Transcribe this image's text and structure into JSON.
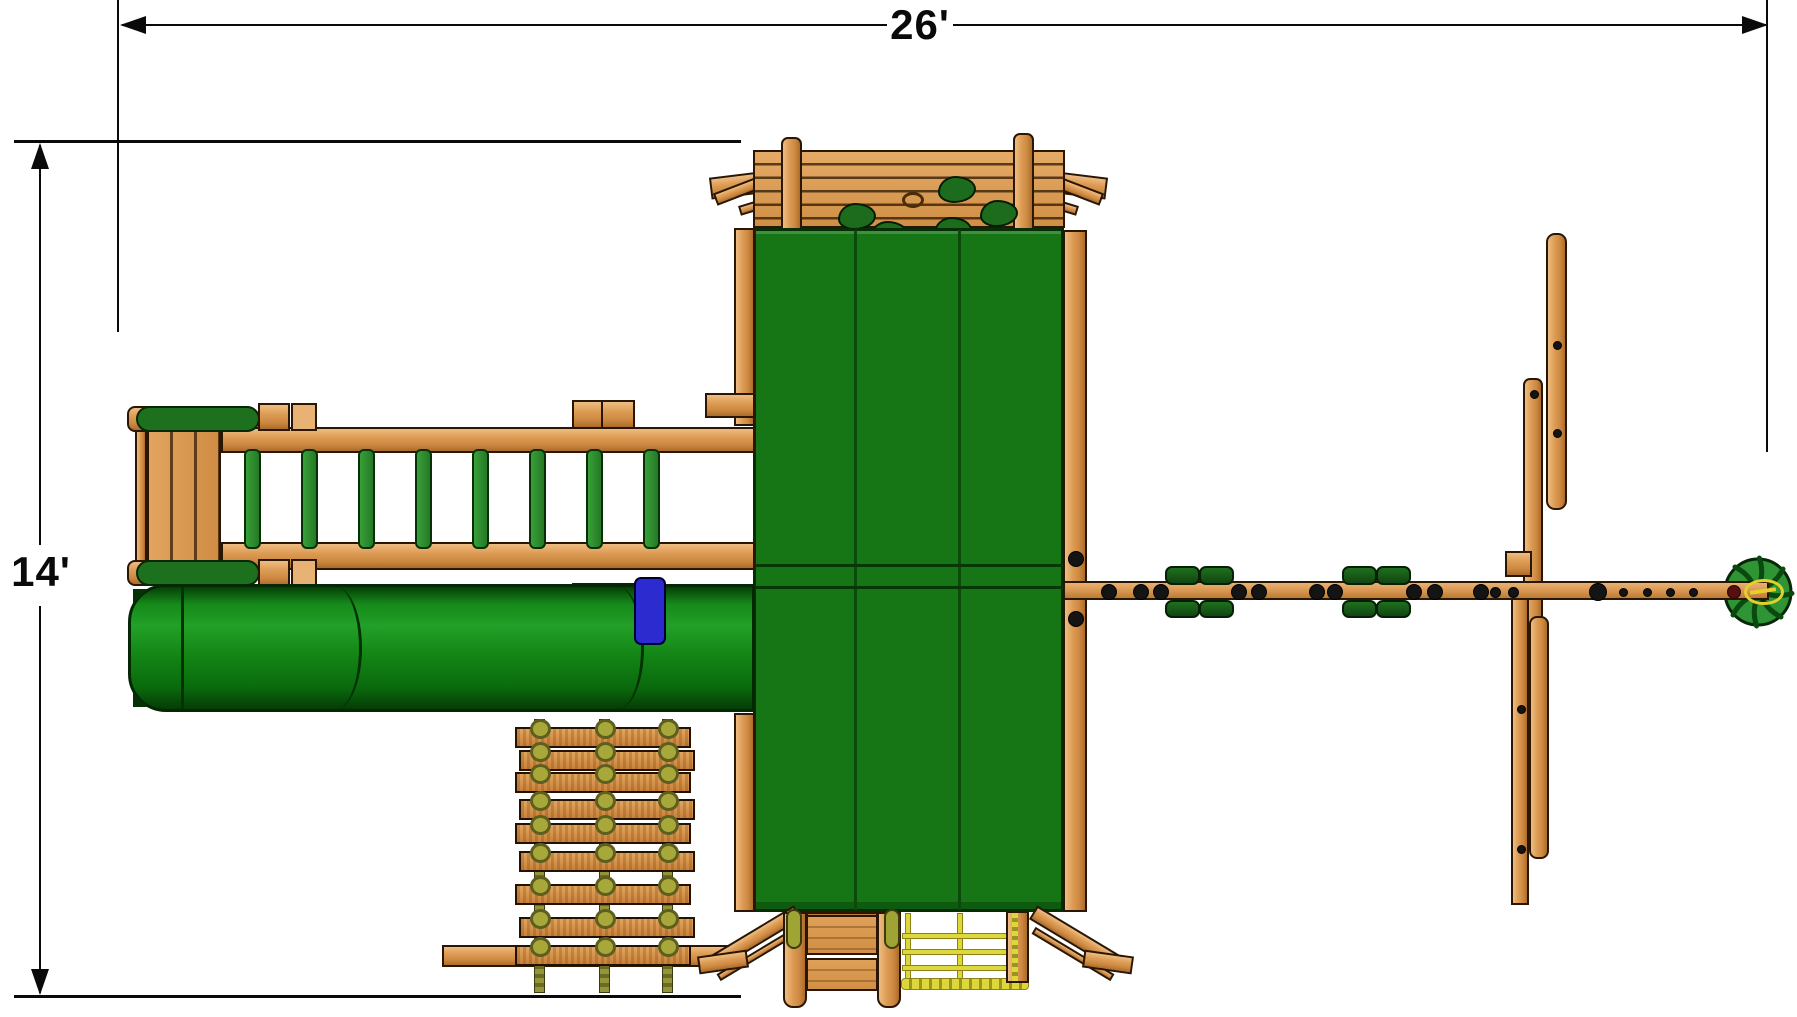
{
  "diagram": {
    "kind": "playset-plan-view",
    "width_label": "26'",
    "height_label": "14'"
  },
  "colors": {
    "dimension_line": "#0a0a0a",
    "wood": "#dd9c55",
    "wood_shadow": "#ab6c2b",
    "outline": "#2b1603",
    "canopy_green": "#167616",
    "canopy_seam": "#0a4a0a",
    "tube_green": "#1d9422",
    "rung_green": "#2d8c2d",
    "swing_seat_green": "#175a17",
    "rock_hold_green": "#1d6b1d",
    "rope_olive": "#8d8d33",
    "rope_yellow": "#ddd73c",
    "slide_entry_blue": "#2b2bd0",
    "bolt_black": "#141414",
    "bolt_dark_red": "#571010",
    "wheel_green": "#2e9434",
    "wheel_spoke": "#0a4a10",
    "emblem_yellow": "#e6cf2d"
  },
  "figure": {
    "rock_holds": [
      [
        838,
        203
      ],
      [
        938,
        176
      ],
      [
        934,
        217
      ],
      [
        980,
        200
      ],
      [
        870,
        221
      ]
    ],
    "rock_hold_ring": [
      902,
      192
    ],
    "monkey_bar": {
      "rung_xs": [
        244,
        301,
        358,
        415,
        472,
        529,
        586,
        643
      ],
      "rung_top": 449
    },
    "rope_ladder": {
      "row_tops": [
        727,
        750,
        772,
        799,
        823,
        851,
        884,
        917,
        945
      ],
      "slat_x": 515,
      "slat_w": 172,
      "rope_xs": [
        534,
        599,
        662
      ],
      "rope_top": 719,
      "rope_h": 272
    },
    "rope_net": {
      "verticals": [
        [
          905,
          913,
          72
        ],
        [
          957,
          913,
          72
        ]
      ],
      "horizontals": [
        [
          902,
          933,
          112
        ],
        [
          902,
          949,
          112
        ],
        [
          902,
          965,
          112
        ]
      ],
      "thick_rope": [
        901,
        978,
        126,
        10
      ]
    },
    "swing_beam": {
      "bolts_large_xs": [
        1108,
        1140,
        1160,
        1238,
        1258,
        1316,
        1334,
        1413,
        1434,
        1480
      ],
      "bolts_small_xs": [
        1494,
        1512
      ],
      "bolt_dark_x": 1597,
      "dot_xs": [
        1622,
        1646,
        1669,
        1692
      ],
      "bolt_red_x": 1733,
      "swing_xs": [
        1165,
        1342
      ]
    },
    "far_frame_bolts": [
      [
        1556,
        344
      ],
      [
        1556,
        432
      ],
      [
        1533,
        393
      ],
      [
        1520,
        708
      ],
      [
        1520,
        848
      ]
    ],
    "wheel": {
      "cx": 1758,
      "cy": 592,
      "r": 33,
      "spokes": 8
    }
  }
}
